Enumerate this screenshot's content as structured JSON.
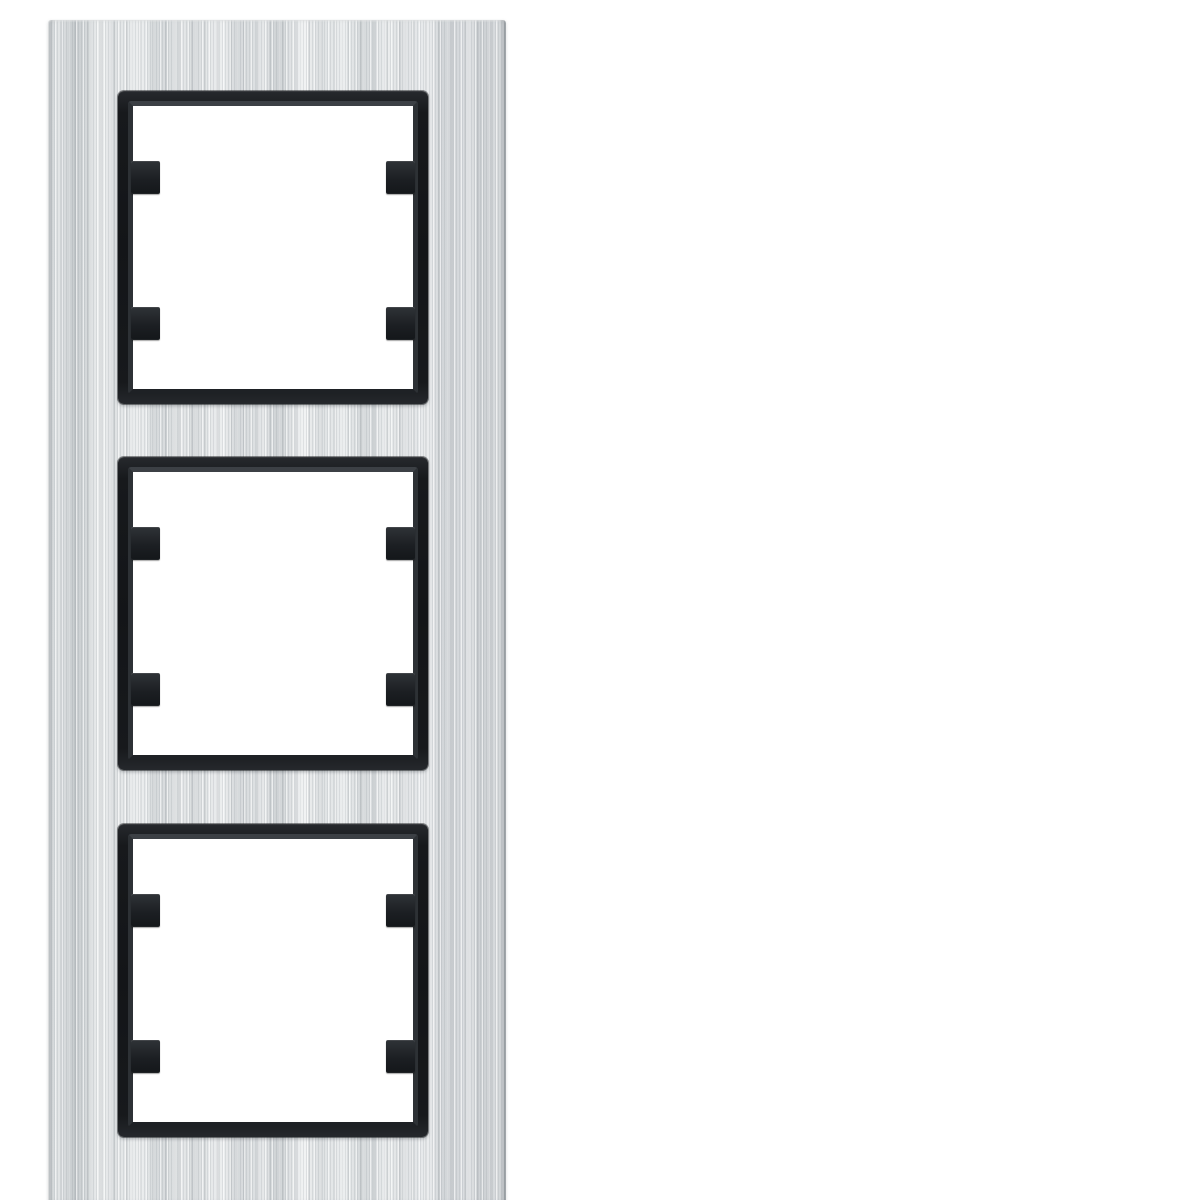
{
  "image": {
    "type": "product-photo",
    "subject": "3-gang vertical cover frame, brushed aluminium with black window inserts and fixing clips",
    "background": "#ffffff"
  },
  "plate": {
    "finish": "brushed-aluminium-vertical-grain",
    "module_count": 3
  },
  "modules": [
    {
      "id": "module-top",
      "position": "top",
      "clips": [
        "top-left",
        "bottom-left",
        "top-right",
        "bottom-right"
      ]
    },
    {
      "id": "module-middle",
      "position": "middle",
      "clips": [
        "top-left",
        "bottom-left",
        "top-right",
        "bottom-right"
      ]
    },
    {
      "id": "module-bottom",
      "position": "bottom",
      "clips": [
        "top-left",
        "bottom-left",
        "top-right",
        "bottom-right"
      ]
    }
  ],
  "colors": {
    "background": "#ffffff",
    "plate_base": "#e0e3e5",
    "plate_streak_dark": "#c6cacd",
    "plate_streak_light": "#f3f5f6",
    "plate_edge": "#9fa5a9",
    "frame_black": "#17191c",
    "frame_bevel": "#3c4045",
    "opening_white": "#ffffff",
    "clip_black": "#1f2226",
    "clip_highlight": "#2f3337"
  }
}
